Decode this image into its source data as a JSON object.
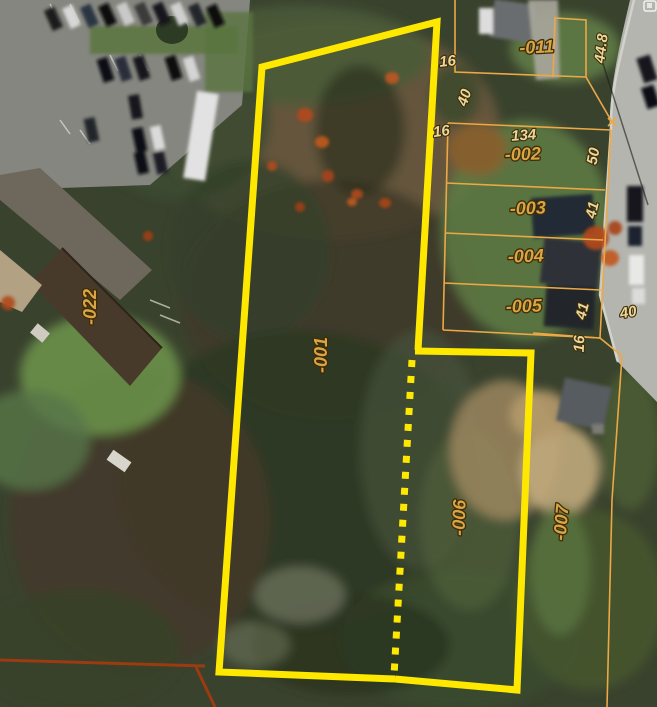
{
  "map": {
    "parcel_labels": {
      "p001": "-001",
      "p002": "-002",
      "p003": "-003",
      "p004": "-004",
      "p005": "-005",
      "p006": "-006",
      "p007": "-007",
      "p011": "-011",
      "p022": "-022"
    },
    "dimension_labels": {
      "d16_a": "16",
      "d16_b": "16",
      "d16_c": "16",
      "d40_a": "40",
      "d40_b": "40",
      "d41_a": "41",
      "d41_b": "41",
      "d50": "50",
      "d134": "134",
      "d44_8": "44.8"
    },
    "colors": {
      "selected_parcel_outline": "#FFE800",
      "parcel_line": "#ECA845",
      "boundary_line": "#9C3A12",
      "parcel_label_fill": "#D9A545",
      "dimension_label_fill": "#E9D79E"
    }
  }
}
